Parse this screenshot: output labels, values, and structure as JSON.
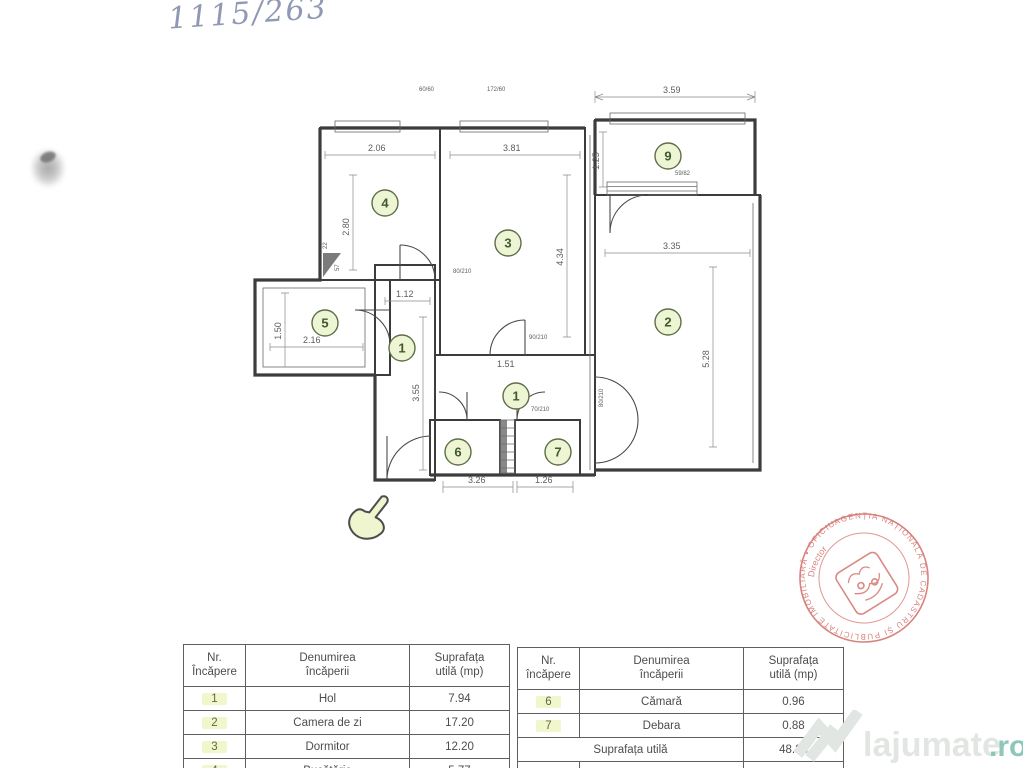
{
  "page": {
    "handwriting": "1115/263"
  },
  "plan": {
    "rooms": {
      "hall_a": "1",
      "hall_b": "1",
      "living": "2",
      "bedroom": "3",
      "kitchen": "4",
      "bath": "5",
      "pantry": "6",
      "debara": "7",
      "balcony": "9"
    },
    "dims": {
      "kitchen_w": "2.06",
      "bedroom_w": "3.81",
      "balcony_top": "3.59",
      "balcony_h": "1.25",
      "kitchen_h": "2.80",
      "bedroom_h": "4.34",
      "living_w": "3.35",
      "living_h": "5.28",
      "bath_w": "2.16",
      "bath_h": "1.50",
      "hall_w": "1.12",
      "hall_h": "3.55",
      "hall_small": "1.51",
      "bottom_a": "3.26",
      "bottom_b": "1.26",
      "door_a": "80/210",
      "door_b": "90/210",
      "door_c": "80/210",
      "door_d": "70/210",
      "win_a": "60/60",
      "win_b": "172/60",
      "win_c": "59/82",
      "vent_a": "22",
      "vent_b": "57"
    }
  },
  "tables": {
    "left": {
      "headers": [
        "Nr.\nÎncăpere",
        "Denumirea\nîncăperii",
        "Suprafața\nutilă (mp)"
      ],
      "rows": [
        [
          "1",
          "Hol",
          "7.94"
        ],
        [
          "2",
          "Camera de zi",
          "17.20"
        ],
        [
          "3",
          "Dormitor",
          "12.20"
        ],
        [
          "4",
          "Bucătărie",
          "5.77"
        ]
      ]
    },
    "right": {
      "headers": [
        "Nr.\nîncăpere",
        "Denumirea\nîncăperii",
        "Suprafața\nutilă (mp)"
      ],
      "rows": [
        [
          "6",
          "Cămară",
          "0.96"
        ],
        [
          "7",
          "Debara",
          "0.88"
        ]
      ],
      "total_label": "Suprafața utilă",
      "total_value": "48.23",
      "footer_row": [
        "8",
        "Suprafața balcoane",
        "0.79"
      ]
    }
  },
  "stamp": {
    "ring_text": "AGENȚIA NAȚIONALĂ DE CADASTRU ȘI PUBLICITATE IMOBILIARĂ • OFICIUL DE CADASTRU •",
    "center_text": "Director",
    "color": "#c9534b"
  },
  "watermark": {
    "name": "lajumate",
    "tld": ".ro"
  }
}
